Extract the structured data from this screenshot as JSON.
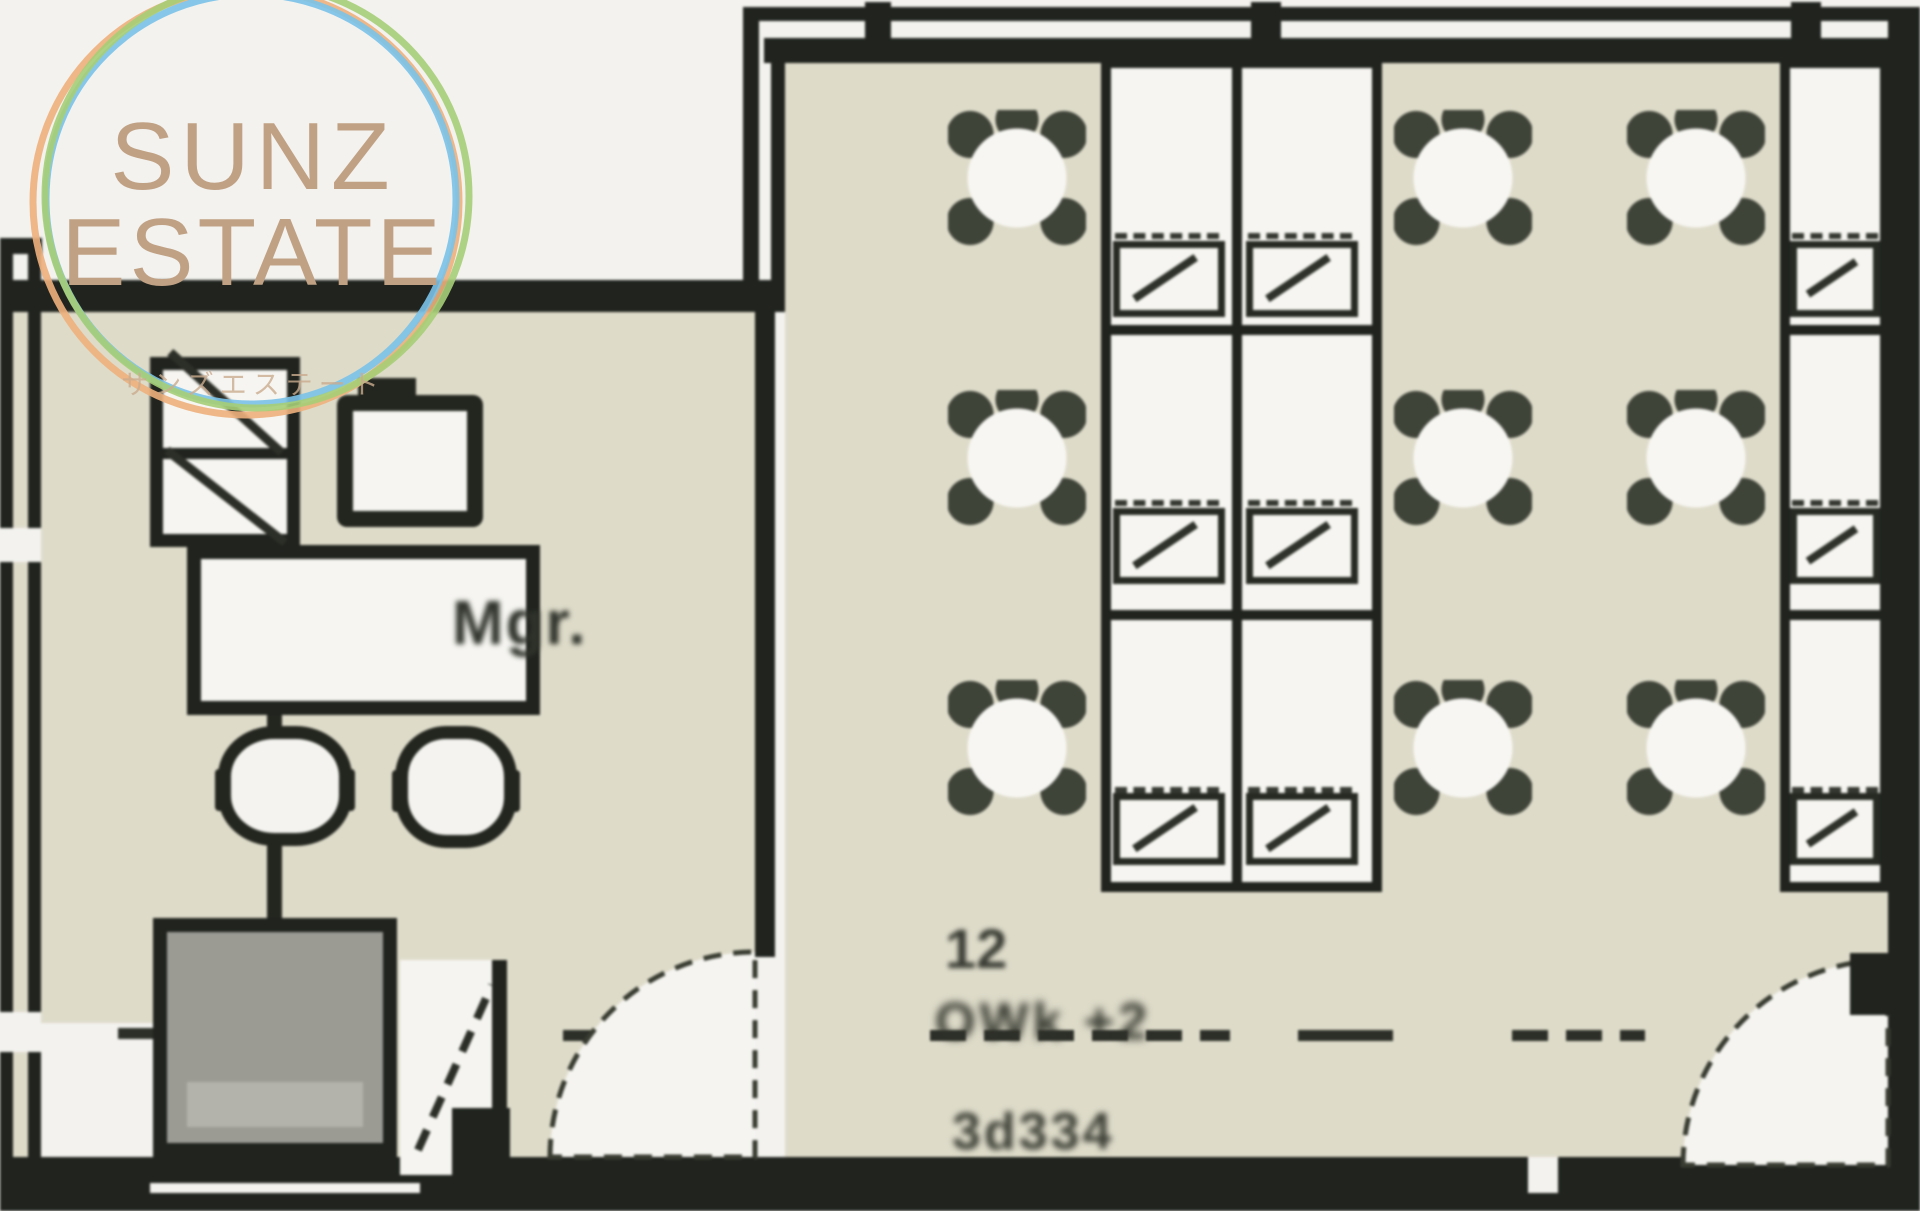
{
  "logo": {
    "line1": "SUNZ",
    "line2": "ESTATE",
    "subtitle": "サンズエステート",
    "text_color": "#c0a184",
    "ring_colors": {
      "green": "#a6ce77",
      "blue": "#7ac2e8",
      "orange": "#eeb07c"
    }
  },
  "floor_plan": {
    "rooms": {
      "manager_office": {
        "label": "Mgr."
      },
      "open_office": {}
    },
    "annotations": {
      "count_label": "12",
      "dimension_label": "OWk +2",
      "area_label": "3d334"
    },
    "inventory": {
      "open_office_desks": 9,
      "open_office_chairs": 9,
      "manager_desk": 1,
      "manager_chair": 1,
      "guest_chairs": 2,
      "cabinet": 1,
      "copier": 1,
      "doors": 2
    },
    "colors": {
      "wall": "#20231e",
      "floor": "#dedbc9",
      "desk": "#f6f5f1",
      "outside": "#f3f2ef",
      "copier_fill": "#9b9b94",
      "chair_dark": "#3f4439",
      "dash_line": "#2c2f28"
    }
  }
}
